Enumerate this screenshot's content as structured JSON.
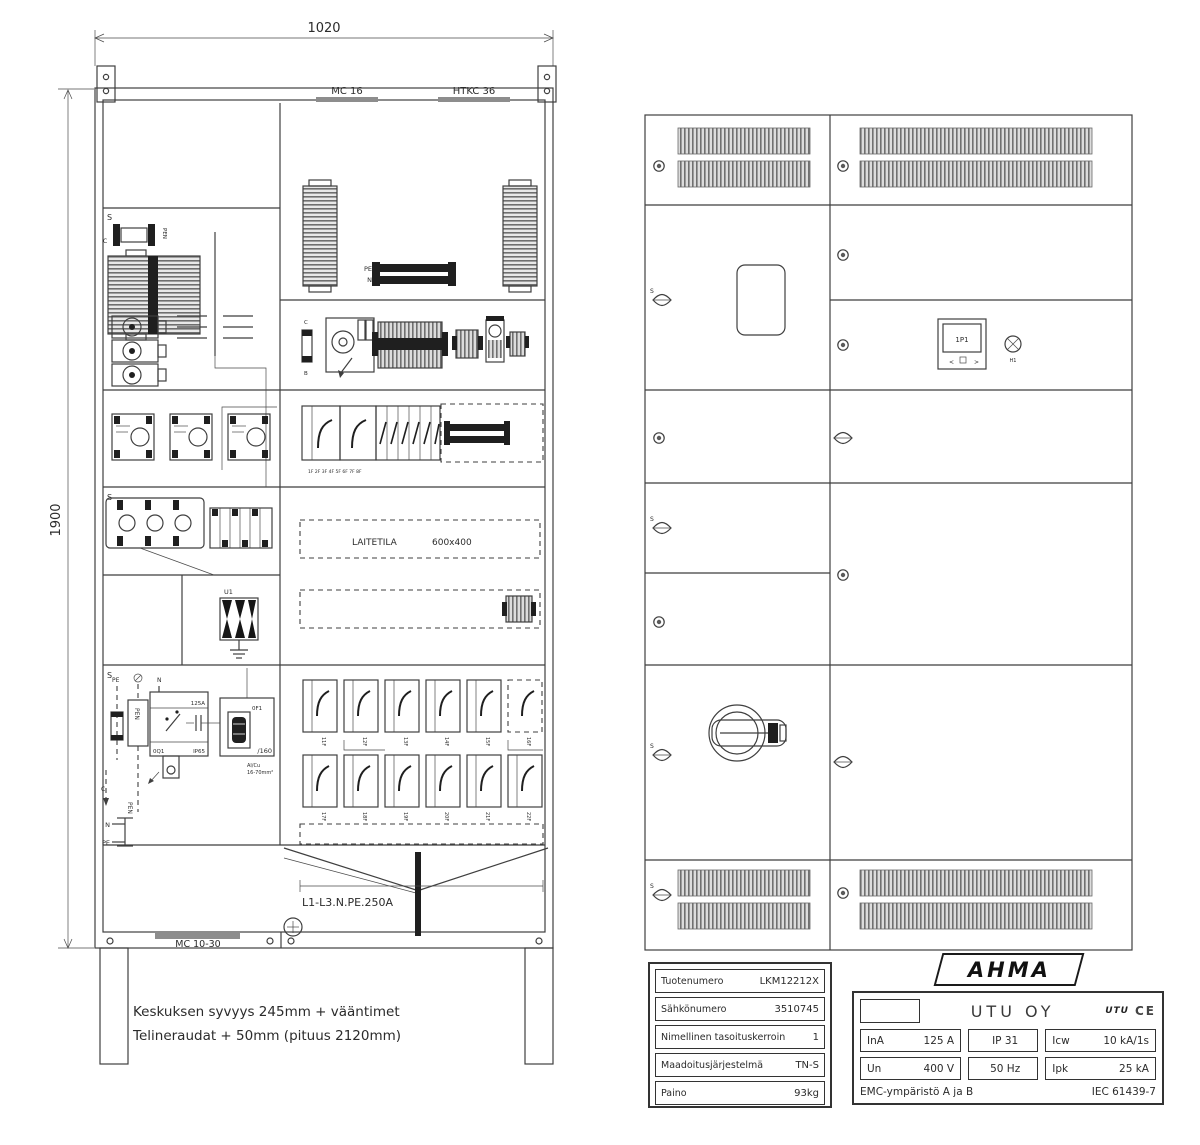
{
  "left_drawing": {
    "dim_width": "1020",
    "dim_height": "1900",
    "rail_top_left": "MC 16",
    "rail_top_right": "HTKC 36",
    "rail_bottom": "MC 10-30",
    "section_letter": "S",
    "labels": {
      "c": "C",
      "b": "B",
      "pen": "PEN",
      "pe": "PE",
      "n": "N",
      "u1": "U1",
      "laitetila": "LAITETILA",
      "laitetila_size": "600x400",
      "busbar_rating": "L1-L3.N.PE.250A",
      "switch_amp": "125A",
      "switch_id": "0Q1",
      "switch_ip": "IP65",
      "fuse_id": "0F1",
      "fuse_size": "/160",
      "fuse_cable1": "Al/Cu",
      "fuse_cable2": "16-70mm²"
    },
    "breaker_top_labels": "1F 2F 3F 4F 5F 6F 7F 8F",
    "breakers_row1": [
      "11F",
      "12F",
      "13F",
      "14F",
      "15F",
      "16F"
    ],
    "breakers_row2": [
      "17F",
      "18F",
      "19F",
      "20F",
      "21F",
      "22F"
    ],
    "notes": [
      "Keskuksen syvyys 245mm + vääntimet",
      "Telineraudat + 50mm (pituus 2120mm)"
    ]
  },
  "right_drawing": {
    "section_letter": "S",
    "meter_id": "1P1",
    "lamp_id": "H1",
    "button_left": "<",
    "button_right": ">"
  },
  "info_table": {
    "rows": [
      {
        "label": "Tuotenumero",
        "value": "LKM12212X"
      },
      {
        "label": "Sähkönumero",
        "value": "3510745"
      },
      {
        "label": "Nimellinen tasoituskerroin",
        "value": "1"
      },
      {
        "label": "Maadoitusjärjestelmä",
        "value": "TN-S"
      },
      {
        "label": "Paino",
        "value": "93kg"
      }
    ]
  },
  "nameplate": {
    "brand": "AHMA",
    "company": "UTU OY",
    "logo": "UTU",
    "ce": "CE",
    "cells": [
      {
        "k": "InA",
        "v": "125 A"
      },
      {
        "k": "",
        "v": "IP 31"
      },
      {
        "k": "Icw",
        "v": "10 kA/1s"
      },
      {
        "k": "Un",
        "v": "400 V"
      },
      {
        "k": "",
        "v": "50 Hz"
      },
      {
        "k": "Ipk",
        "v": "25 kA"
      }
    ],
    "footer_left": "EMC-ympäristö A ja B",
    "footer_right": "IEC 61439-7"
  }
}
